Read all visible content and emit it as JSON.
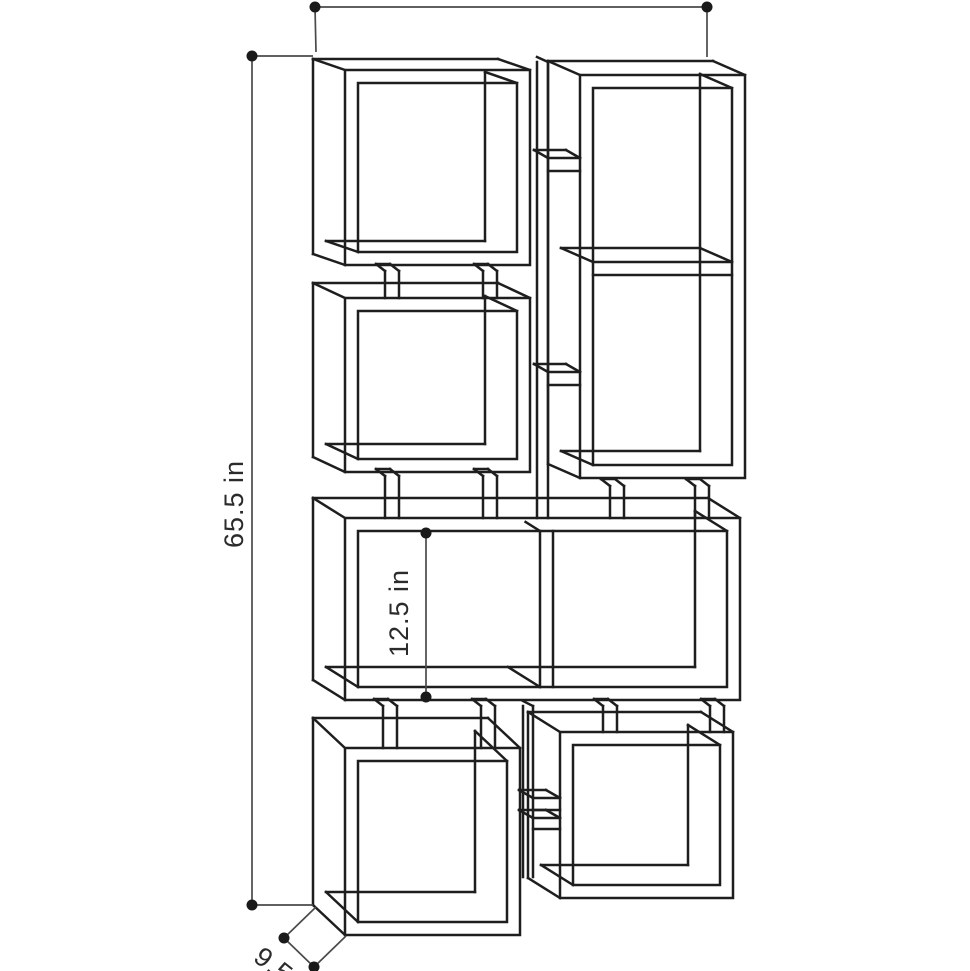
{
  "figure": {
    "kind": "furniture-dimension-diagram",
    "description": "Perspective line drawing of an 8-cube modular bookcase with dimension annotations"
  },
  "dimensions": {
    "height_label": "65.5 in",
    "inner_height_label": "12.5 in",
    "depth_label": "9.5 in"
  },
  "style": {
    "background": "#ffffff",
    "line_color": "#1e1e1e",
    "dim_color": "#4a4a4a",
    "dot_radius": 5.5
  },
  "diagram": {
    "boxes": [
      {
        "id": "box-top-left",
        "x": 345,
        "y": 70,
        "w": 185,
        "h": 195,
        "t": 13,
        "dx": -32,
        "dy": -11
      },
      {
        "id": "box-mid-left",
        "x": 345,
        "y": 298,
        "w": 185,
        "h": 174,
        "t": 13,
        "dx": -32,
        "dy": -15
      },
      {
        "id": "box-tall-right",
        "x": 580,
        "y": 75,
        "w": 165,
        "h": 403,
        "t": 13,
        "dx": -32,
        "dy": -14,
        "shelves": [
          262
        ]
      },
      {
        "id": "box-wide-center",
        "x": 345,
        "y": 518,
        "w": 395,
        "h": 182,
        "t": 13,
        "dx": -32,
        "dy": -20,
        "divider": 540
      },
      {
        "id": "box-bottom-left",
        "x": 345,
        "y": 748,
        "w": 175,
        "h": 187,
        "t": 13,
        "dx": -32,
        "dy": -30
      },
      {
        "id": "box-bottom-right",
        "x": 560,
        "y": 732,
        "w": 173,
        "h": 166,
        "t": 13,
        "dx": -32,
        "dy": -20
      }
    ],
    "posts": {
      "width": 14,
      "sliver_dx": -9,
      "sliver_dy": -7,
      "items": [
        {
          "x": 385,
          "y1": 271,
          "y2": 298
        },
        {
          "x": 483,
          "y1": 271,
          "y2": 298
        },
        {
          "x": 385,
          "y1": 476,
          "y2": 518
        },
        {
          "x": 483,
          "y1": 476,
          "y2": 518
        },
        {
          "x": 610,
          "y1": 486,
          "y2": 518
        },
        {
          "x": 695,
          "y1": 486,
          "y2": 518
        },
        {
          "x": 383,
          "y1": 706,
          "y2": 748
        },
        {
          "x": 481,
          "y1": 706,
          "y2": 748
        },
        {
          "x": 603,
          "y1": 706,
          "y2": 732
        },
        {
          "x": 710,
          "y1": 706,
          "y2": 732
        }
      ]
    },
    "columns": [
      {
        "verts": [
          537,
          548
        ],
        "y1": 62,
        "y2": 518,
        "shelves": [
          {
            "x1": 548,
            "x2": 580,
            "y": 158,
            "t": 13
          },
          {
            "x1": 548,
            "x2": 580,
            "y": 372,
            "t": 13
          }
        ]
      },
      {
        "verts": [
          523,
          533
        ],
        "y1": 706,
        "y2": 877,
        "shelves": [
          {
            "x1": 533,
            "x2": 560,
            "y": 798,
            "t": 12
          },
          {
            "x1": 533,
            "x2": 560,
            "y": 818,
            "t": 11
          }
        ]
      }
    ],
    "shelf_sliver": {
      "dx": -14,
      "dy": -8
    },
    "dim_lines": [
      {
        "id": "width-dim",
        "x1": 315,
        "y1": 7,
        "x2": 707,
        "y2": 7,
        "exts": [
          [
            315,
            7,
            316,
            52
          ],
          [
            707,
            7,
            707,
            57
          ]
        ]
      },
      {
        "id": "height-dim",
        "x1": 252,
        "y1": 56,
        "x2": 252,
        "y2": 905,
        "exts": [
          [
            252,
            56,
            313,
            56
          ],
          [
            252,
            905,
            313,
            905
          ]
        ]
      },
      {
        "id": "inner-height-dim",
        "x1": 426,
        "y1": 533,
        "x2": 426,
        "y2": 697,
        "exts": []
      },
      {
        "id": "depth-dim",
        "x1": 284,
        "y1": 938,
        "x2": 314,
        "y2": 967,
        "exts": [
          [
            284,
            938,
            316,
            907
          ],
          [
            314,
            967,
            346,
            936
          ]
        ]
      }
    ]
  }
}
